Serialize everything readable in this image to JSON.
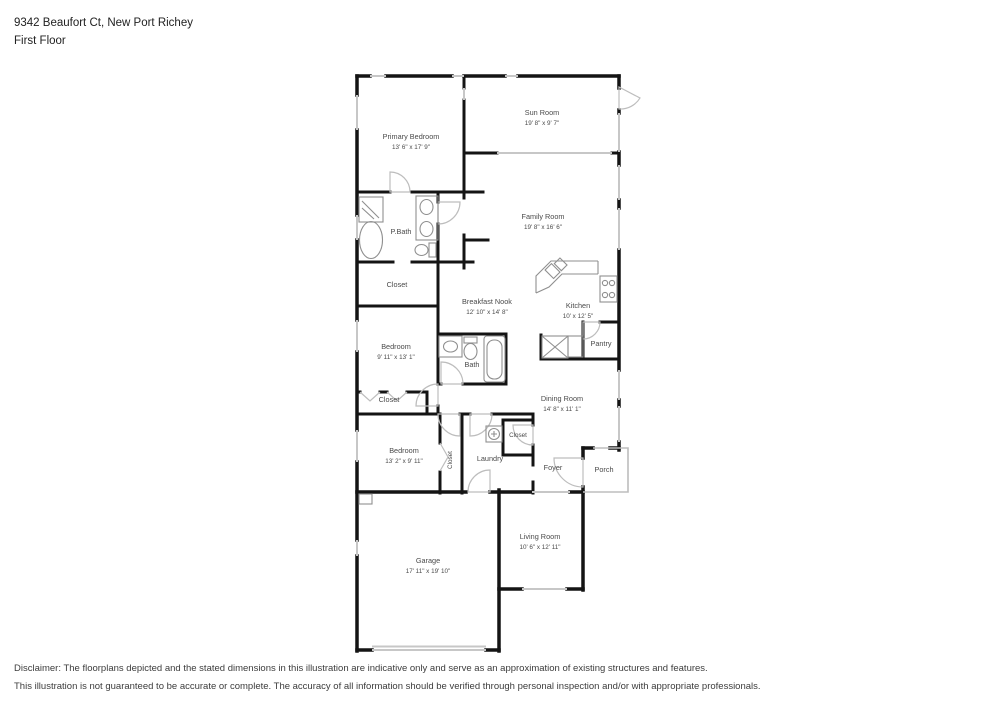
{
  "header": {
    "address": "9342 Beaufort Ct, New Port Richey",
    "floor": "First Floor"
  },
  "rooms": {
    "primary_bedroom": {
      "name": "Primary Bedroom",
      "dims": "13' 6\" x 17' 9\""
    },
    "sun_room": {
      "name": "Sun Room",
      "dims": "19' 8\" x 9' 7\""
    },
    "family_room": {
      "name": "Family Room",
      "dims": "19' 8\" x 16' 6\""
    },
    "p_bath": {
      "name": "P.Bath"
    },
    "closet_pbath": {
      "name": "Closet"
    },
    "breakfast_nook": {
      "name": "Breakfast Nook",
      "dims": "12' 10\" x 14' 8\""
    },
    "kitchen": {
      "name": "Kitchen",
      "dims": "10' x 12' 5\""
    },
    "pantry": {
      "name": "Pantry"
    },
    "bedroom2": {
      "name": "Bedroom",
      "dims": "9' 11\" x 13' 1\""
    },
    "bath2": {
      "name": "Bath"
    },
    "closet_bedroom2": {
      "name": "Closet"
    },
    "dining_room": {
      "name": "Dining Room",
      "dims": "14' 8\" x 11' 1\""
    },
    "bedroom3": {
      "name": "Bedroom",
      "dims": "13' 2\" x 9' 11\""
    },
    "closet_hall": {
      "name": "Closet"
    },
    "laundry": {
      "name": "Laundry"
    },
    "closet_entry": {
      "name": "Closet"
    },
    "foyer": {
      "name": "Foyer"
    },
    "porch": {
      "name": "Porch"
    },
    "garage": {
      "name": "Garage",
      "dims": "17' 11\" x 19' 10\""
    },
    "living_room": {
      "name": "Living Room",
      "dims": "10' 6\" x 12' 11\""
    }
  },
  "disclaimer": {
    "line1": "Disclaimer: The floorplans depicted and the stated dimensions in this illustration are indicative only and serve as an approximation of existing structures and features.",
    "line2": "This illustration is not guaranteed to be accurate or complete. The accuracy of all information should be verified through personal inspection and/or with appropriate professionals."
  },
  "colors": {
    "wall": "#141414",
    "window": "#c7c7c7",
    "door_swing": "#bdbdbd",
    "fixture": "#8f8f8f",
    "label_text": "#4a4a4a"
  }
}
